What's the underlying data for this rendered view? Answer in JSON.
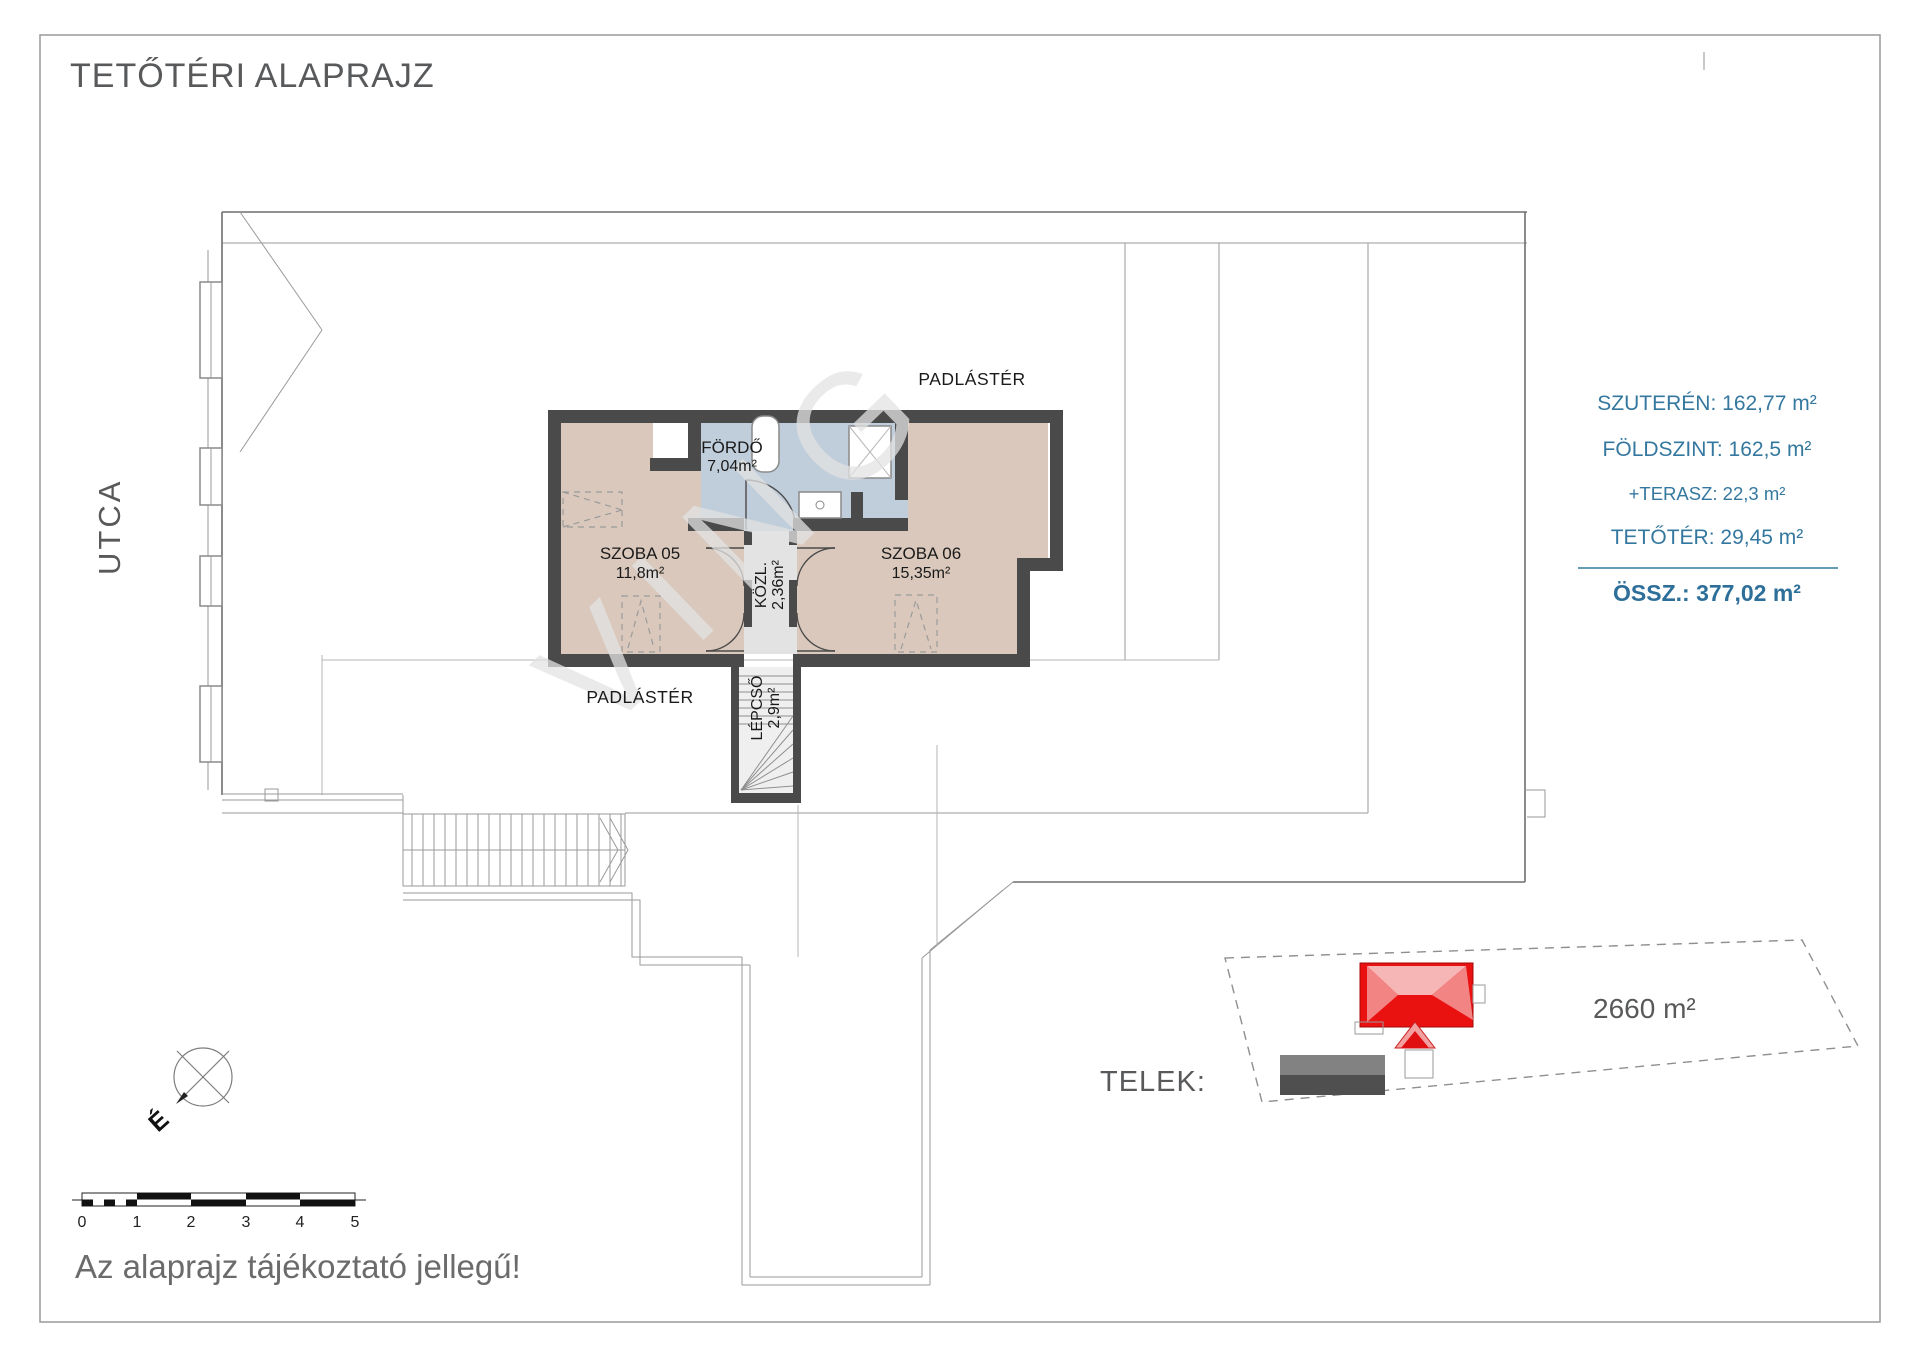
{
  "page": {
    "title": "TETŐTÉRI ALAPRAJZ",
    "street_label": "UTCA",
    "disclaimer": "Az alaprajz tájékoztató jellegű!",
    "watermark": "VING"
  },
  "plan": {
    "attic_label_top": "PADLÁSTÉR",
    "attic_label_bottom": "PADLÁSTÉR",
    "compass_north": "É",
    "rooms": [
      {
        "name": "FÖRDŐ",
        "area": "7,04m²"
      },
      {
        "name": "SZOBA 05",
        "area": "11,8m²"
      },
      {
        "name": "SZOBA 06",
        "area": "15,35m²"
      },
      {
        "name": "KÖZL.",
        "area": "2,36m²"
      },
      {
        "name": "LÉPCSŐ",
        "area": "2,9m²"
      }
    ]
  },
  "summary": {
    "lines": [
      "SZUTERÉN: 162,77 m²",
      "FÖLDSZINT: 162,5 m²",
      "+TERASZ: 22,3 m²",
      "TETŐTÉR: 29,45 m²"
    ],
    "total": "ÖSSZ.: 377,02 m²"
  },
  "site": {
    "label": "TELEK:",
    "area": "2660 m²"
  },
  "scale_bar": {
    "labels": [
      "0",
      "1",
      "2",
      "3",
      "4",
      "5"
    ]
  },
  "colors": {
    "accent_blue": "#35789f",
    "wall_gray": "#4a4a4a",
    "room_beige": "#d9c8bb",
    "bath_blue": "#c0cdda",
    "corridor_gray": "#e3e3e3",
    "roof_red": "#ea1111"
  }
}
